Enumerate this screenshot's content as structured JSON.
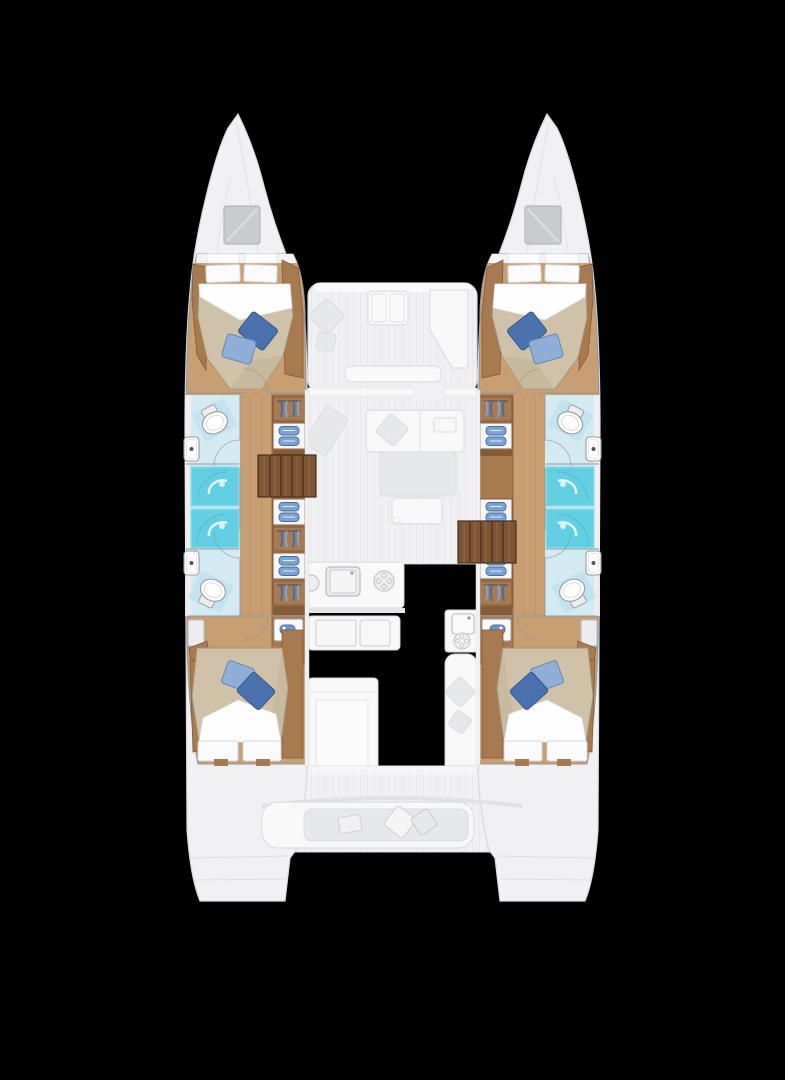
{
  "plan": {
    "type": "catamaran-floor-plan",
    "view": "top-down-bow-up",
    "hulls": [
      {
        "name": "port-hull",
        "areas": [
          {
            "name": "bow-locker",
            "features": [
              "deck-hatch"
            ]
          },
          {
            "name": "forward-cabin",
            "features": [
              "double-berth",
              "white-pillows-2",
              "blue-accent-pillows-2"
            ]
          },
          {
            "name": "forward-head",
            "features": [
              "toilet",
              "washbasin"
            ]
          },
          {
            "name": "shower-stalls",
            "features": [
              "shower",
              "shower"
            ]
          },
          {
            "name": "aft-head",
            "features": [
              "toilet",
              "washbasin"
            ]
          },
          {
            "name": "aft-cabin",
            "features": [
              "double-berth",
              "white-pillows-2",
              "blue-accent-pillows-2"
            ]
          },
          {
            "name": "wardrobe-band",
            "features": [
              "hanging-locker",
              "folded-storage",
              "hanging-locker",
              "folded-storage",
              "vanity"
            ]
          },
          {
            "name": "companionway-steps",
            "features": [
              "5-treads"
            ]
          }
        ]
      },
      {
        "name": "starboard-hull",
        "mirrored": true,
        "areas": [
          {
            "name": "bow-locker",
            "features": [
              "deck-hatch"
            ]
          },
          {
            "name": "forward-cabin",
            "features": [
              "double-berth",
              "white-pillows-2",
              "blue-accent-pillows-2"
            ]
          },
          {
            "name": "forward-head",
            "features": [
              "toilet",
              "washbasin"
            ]
          },
          {
            "name": "shower-stalls",
            "features": [
              "shower",
              "shower"
            ]
          },
          {
            "name": "aft-head",
            "features": [
              "toilet",
              "washbasin"
            ]
          },
          {
            "name": "aft-cabin",
            "features": [
              "double-berth",
              "white-pillows-2",
              "blue-accent-pillows-2"
            ]
          },
          {
            "name": "wardrobe-band",
            "features": [
              "hanging-locker",
              "folded-storage",
              "hanging-locker",
              "folded-storage",
              "vanity"
            ]
          },
          {
            "name": "companionway-steps",
            "features": [
              "5-treads"
            ]
          }
        ]
      }
    ],
    "bridgedeck": {
      "areas": [
        {
          "name": "forward-cockpit",
          "features": [
            "table",
            "l-bench",
            "cushions"
          ]
        },
        {
          "name": "saloon",
          "features": [
            "sofa",
            "dining-table",
            "chart-seat"
          ]
        },
        {
          "name": "galley",
          "features": [
            "sink",
            "stove-burners",
            "island",
            "side-counter"
          ]
        },
        {
          "name": "aft-cockpit",
          "features": [
            "curved-bench",
            "cushions",
            "table"
          ]
        },
        {
          "name": "transom-platforms",
          "features": [
            "port-steps",
            "starboard-steps"
          ]
        }
      ]
    }
  },
  "colors": {
    "bg": "#000000",
    "ghost": "#f1f1f3",
    "ghost-line": "#d8d9db",
    "ghost-dark": "#e7e8ea",
    "stripe": "#e9eaec",
    "white": "#f8f8f9",
    "wall-line": "#96969b",
    "floor": "#c79f73",
    "floor-line": "#b1895d",
    "cab": "#a87a50",
    "cab-dark": "#855b38",
    "stairs": "#7d5434",
    "stairs-line": "#54371f",
    "stairs-hi": "#9c6f45",
    "duvet": "#cfc2a8",
    "duvet-line": "#a2947c",
    "pillow-dark": "#4a72ae",
    "pillow-dark-line": "#35578c",
    "pillow-light": "#8fafd8",
    "pillow-light-line": "#6488b5",
    "pillow-stroke": "#d6d6d8",
    "bath": "#d4eaf3",
    "bath-mat": "#c0e2ee",
    "shower": "#63cfe2",
    "shower-line": "#8fdde9",
    "shower-swirl": "#e2f7fa",
    "fixture": "#ffffff",
    "fixture-line": "#9a9aa0",
    "clothes": "#7ba3d4",
    "clothes-dark": "#4a6da0",
    "hatch": "#c9cbcf",
    "hatch-line": "#b5b7ba"
  }
}
